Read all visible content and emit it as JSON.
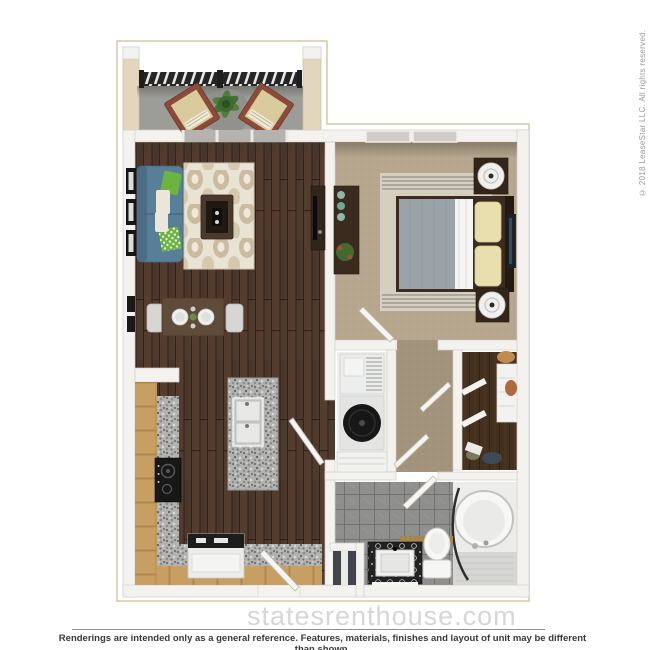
{
  "watermark": {
    "text": "statesrenthouse.com"
  },
  "footer": {
    "disclaimer": "Renderings are intended only as a general reference. Features, materials, finishes and layout of unit may be different than shown."
  },
  "copyright": {
    "text": "© 2018 LeaseStar LLC. All rights reserved."
  },
  "palette": {
    "page-bg": "#ffffff",
    "plan-border": "#d8c8a4",
    "wall": "#f3f2ef",
    "wall-edge": "#d2cfca",
    "balcony-wall": "#e2d6bc",
    "balcony-floor": "#9c9c98",
    "wood-floor": "#4f3a2e",
    "carpet-bed": "#b6a78e",
    "carpet-hall": "#a2947c",
    "tile-floor": "#8e8e8c",
    "closet-floor": "#44301f",
    "granite": "#b4b4b2",
    "cabinet-wood": "#c79f63",
    "sofa-blue": "#587e98",
    "pillow-green": "#6cb340",
    "rug-cream": "#e9e3d3",
    "rug-tan": "#ab9572",
    "furniture-dark": "#35271d",
    "appliance-black": "#1b1b1b",
    "white-fixture": "#f6f6f4",
    "watermark": "#cdcdcd",
    "text-dark": "#3a3a3a",
    "text-gray": "#9b9b9b"
  }
}
